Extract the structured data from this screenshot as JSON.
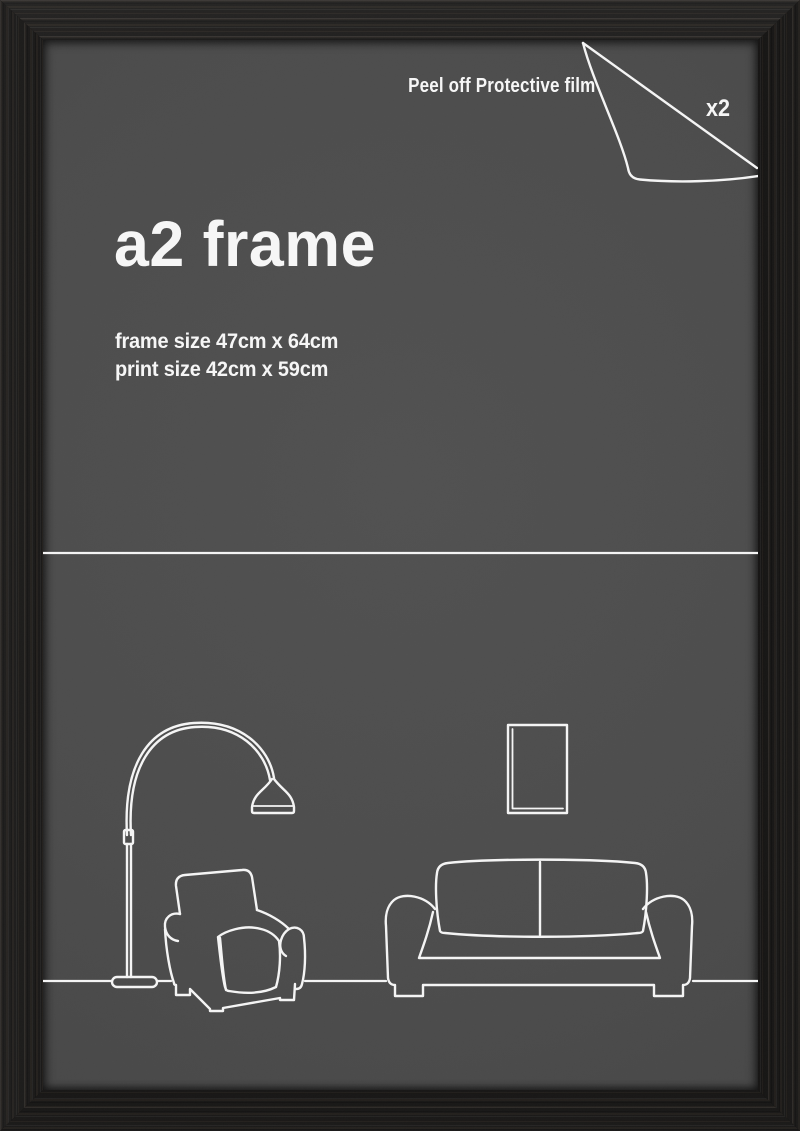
{
  "image_type": "product-photo-of-picture-frame",
  "product": {
    "title": "a2 frame",
    "frame_size": "frame size 47cm x 64cm",
    "print_size": "print size 42cm x 59cm"
  },
  "annotations": {
    "peel_instruction": "Peel off Protective film",
    "quantity": "x2"
  },
  "illustrations": [
    "protective-film-peeling-corner",
    "arc-floor-lamp",
    "armchair",
    "two-seat-sofa",
    "wall-picture-frame",
    "floor-line",
    "divider-line"
  ],
  "colors": {
    "frame_wood": "#0c0b0a",
    "insert_background": "#4b4b4b",
    "line_art": "#f4f4f4",
    "text": "#f6f6f6"
  }
}
